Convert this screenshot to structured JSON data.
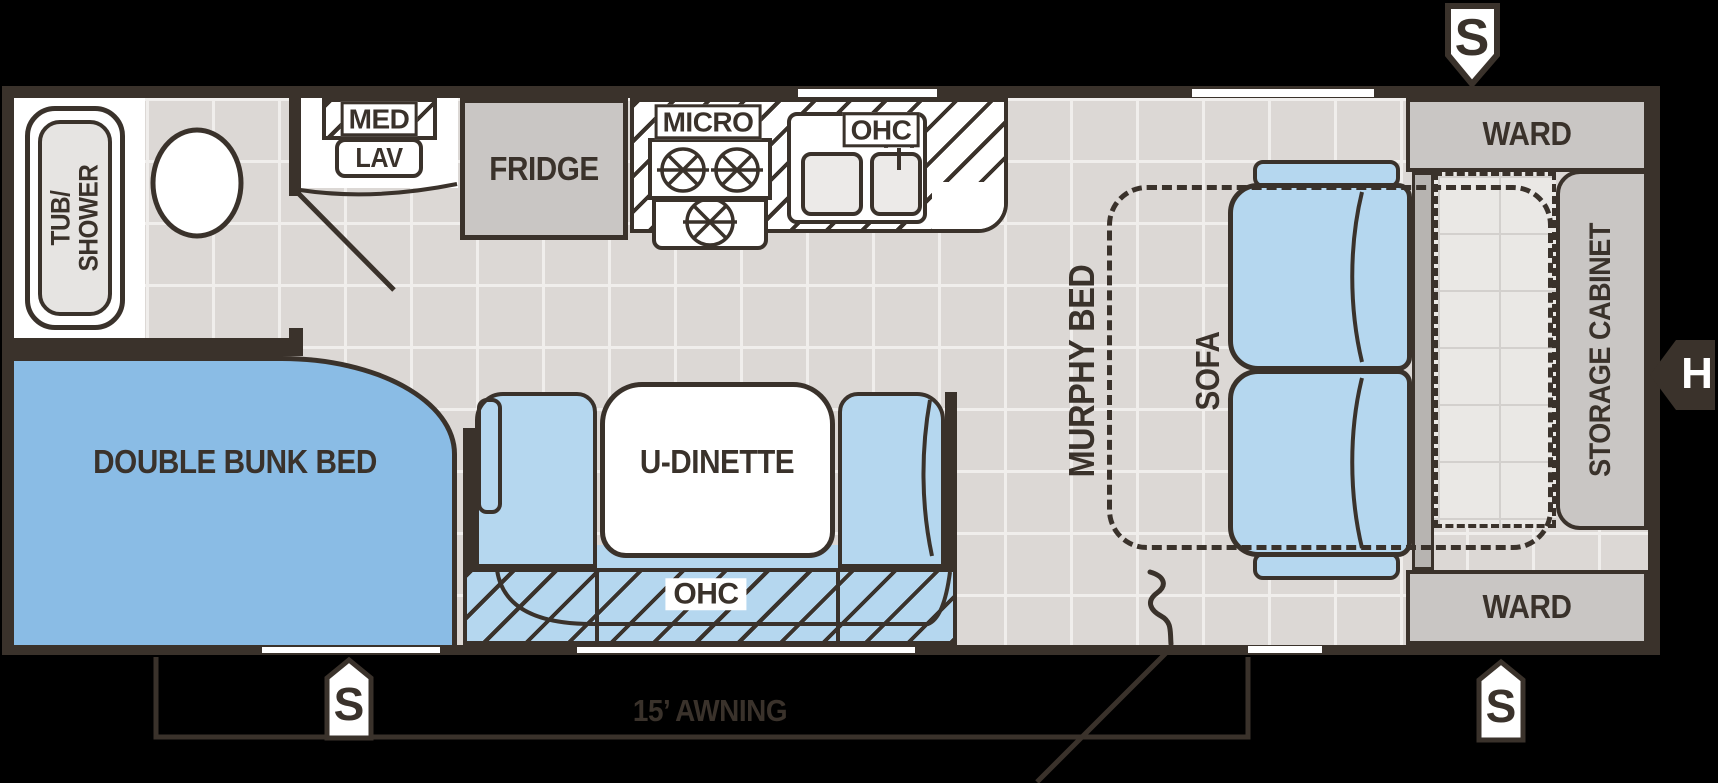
{
  "colors": {
    "outline": "#3a322b",
    "floor_tile": "#dcd8d5",
    "grout": "#f0eeec",
    "furniture_blue": "#b5d7ef",
    "bunk_blue": "#8abce5",
    "cabinet_gray": "#c9c6c4",
    "mattress_gray": "#eae8e5",
    "white": "#ffffff"
  },
  "labels": {
    "tub1": "TUB/",
    "tub2": "SHOWER",
    "med": "MED",
    "lav": "LAV",
    "fridge": "FRIDGE",
    "micro": "MICRO",
    "ohc_kitchen": "OHC",
    "ohc_dinette": "OHC",
    "u_dinette": "U-DINETTE",
    "double_bunk_bed": "DOUBLE BUNK BED",
    "murphy_bed": "MURPHY BED",
    "sofa": "SOFA",
    "ward_top": "WARD",
    "ward_bottom": "WARD",
    "storage_cabinet": "STORAGE CABINET",
    "awning": "15’ AWNING"
  },
  "markers": {
    "top_s": "S",
    "bottom_left_s": "S",
    "bottom_right_s": "S",
    "right_h": "H"
  }
}
